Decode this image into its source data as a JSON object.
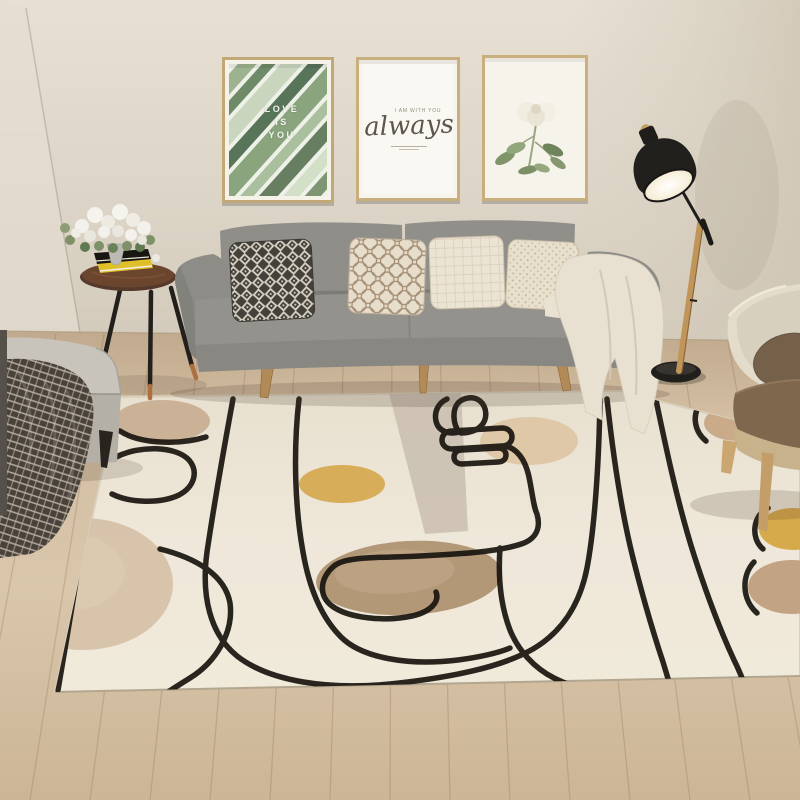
{
  "scene": {
    "label": "modern living room with abstract line-art area rug"
  },
  "frames": {
    "left": {
      "line1": "LOVE",
      "line2": "IS",
      "line3": "YOU"
    },
    "middle": {
      "caption": "I AM WITH YOU",
      "script": "always"
    },
    "right": {
      "subject": "white flower print"
    }
  },
  "palette": {
    "wall": "#ded6c8",
    "floor_wood": "#d3bea2",
    "rug_cream": "#ede6d7",
    "sofa_grey": "#8f8e89",
    "line_art_black": "#18140f",
    "accent_yellow": "#d6a84e",
    "accent_brown": "#b39878",
    "lamp_black": "#21201d",
    "lamp_wood": "#c09559"
  },
  "objects": [
    "three framed wall prints",
    "grey three-seat sofa with four patterned cushions",
    "cream throw blanket",
    "black and wood floor lamp",
    "round tripod side table with books and flowers",
    "grey ottoman with plaid blanket",
    "beige boucle armchair",
    "abstract one-line-art area rug",
    "oak plank floor"
  ]
}
